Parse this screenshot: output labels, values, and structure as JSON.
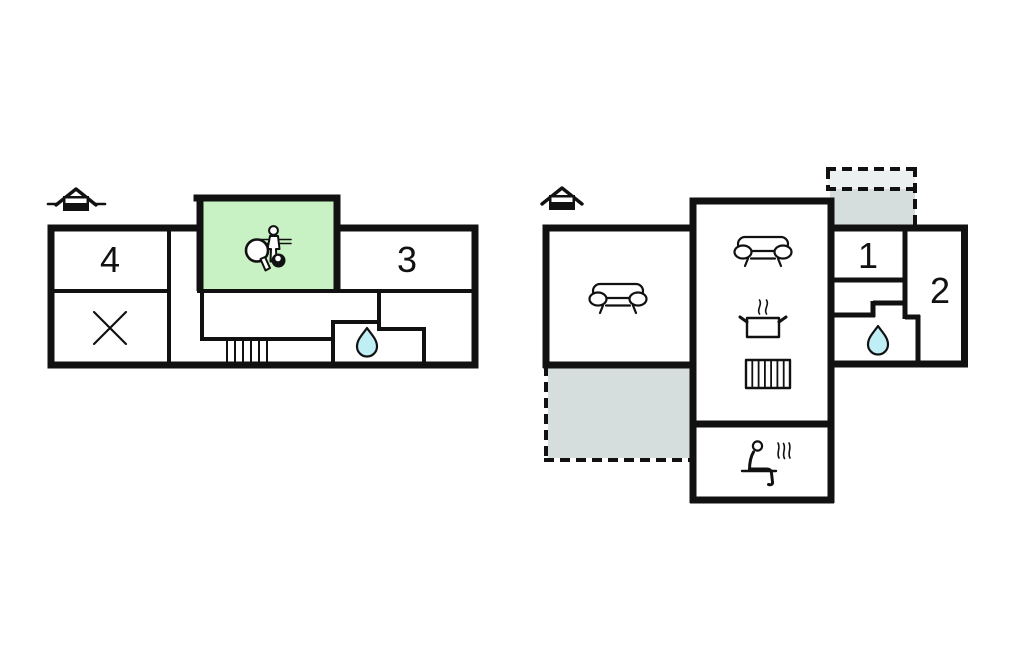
{
  "colors": {
    "wall": "#111111",
    "accent_green": "#c8f2c3",
    "water_blue": "#bfeef4",
    "terrace_gray": "#d6dddd",
    "terrace_gray_light": "#edf0f0",
    "background": "#ffffff"
  },
  "upper_plan": {
    "rooms": [
      {
        "id": "room-4",
        "label": "4"
      },
      {
        "id": "room-3",
        "label": "3"
      }
    ],
    "icons": [
      "house-entrance-icon",
      "table-tennis-paddle-icon",
      "billiard-ball-icon",
      "foosball-player-icon",
      "closet-x-icon",
      "stairs-icon",
      "water-drop-icon"
    ]
  },
  "ground_plan": {
    "rooms": [
      {
        "id": "room-1",
        "label": "1"
      },
      {
        "id": "room-2",
        "label": "2"
      }
    ],
    "icons": [
      "house-entrance-icon",
      "sofa-icon",
      "sofa-icon",
      "cooking-pot-icon",
      "radiator-icon",
      "water-drop-icon",
      "sauna-icon",
      "terrace-dashed-area",
      "terrace-dashed-area"
    ]
  }
}
